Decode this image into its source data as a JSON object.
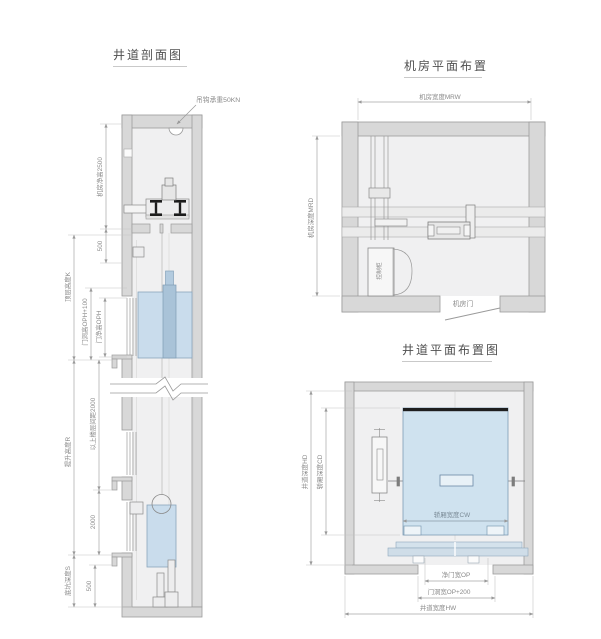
{
  "section_view": {
    "title": "井道剖面图",
    "labels": {
      "hook": "吊钩承重50KN",
      "machine_room_height": "机房净高2500",
      "dim_500_top": "500",
      "top_floor_height": "顶层高度K",
      "door_opening_height": "门洞高OPH+100",
      "door_clear_height": "门净高OPH",
      "travel_height": "提升高度R",
      "upper_floor_distance": "以上楼层间距2000",
      "dim_2000": "2000",
      "pit_depth": "底坑深度S",
      "dim_500_bottom": "500"
    }
  },
  "machine_room_plan": {
    "title": "机房平面布置",
    "labels": {
      "width": "机房宽度MRW",
      "depth": "机房深度MRD",
      "control_cabinet": "控制柜",
      "door": "机房门"
    }
  },
  "shaft_plan": {
    "title": "井道平面布置图",
    "labels": {
      "car_width": "轿厢宽度CW",
      "shaft_depth": "井道深度HD",
      "car_depth": "轿厢深度CD",
      "door_clear_width": "净门宽OP",
      "door_opening_width": "门洞宽OP+200",
      "shaft_width": "井道宽度HW"
    }
  },
  "colors": {
    "wall": "#d8d8d8",
    "floor": "#f0f0f1",
    "car_fill": "#cfe2ef",
    "sling_fill": "#a9c3d8",
    "dim_line": "#b0b0b0",
    "text": "#8a8a8a"
  }
}
